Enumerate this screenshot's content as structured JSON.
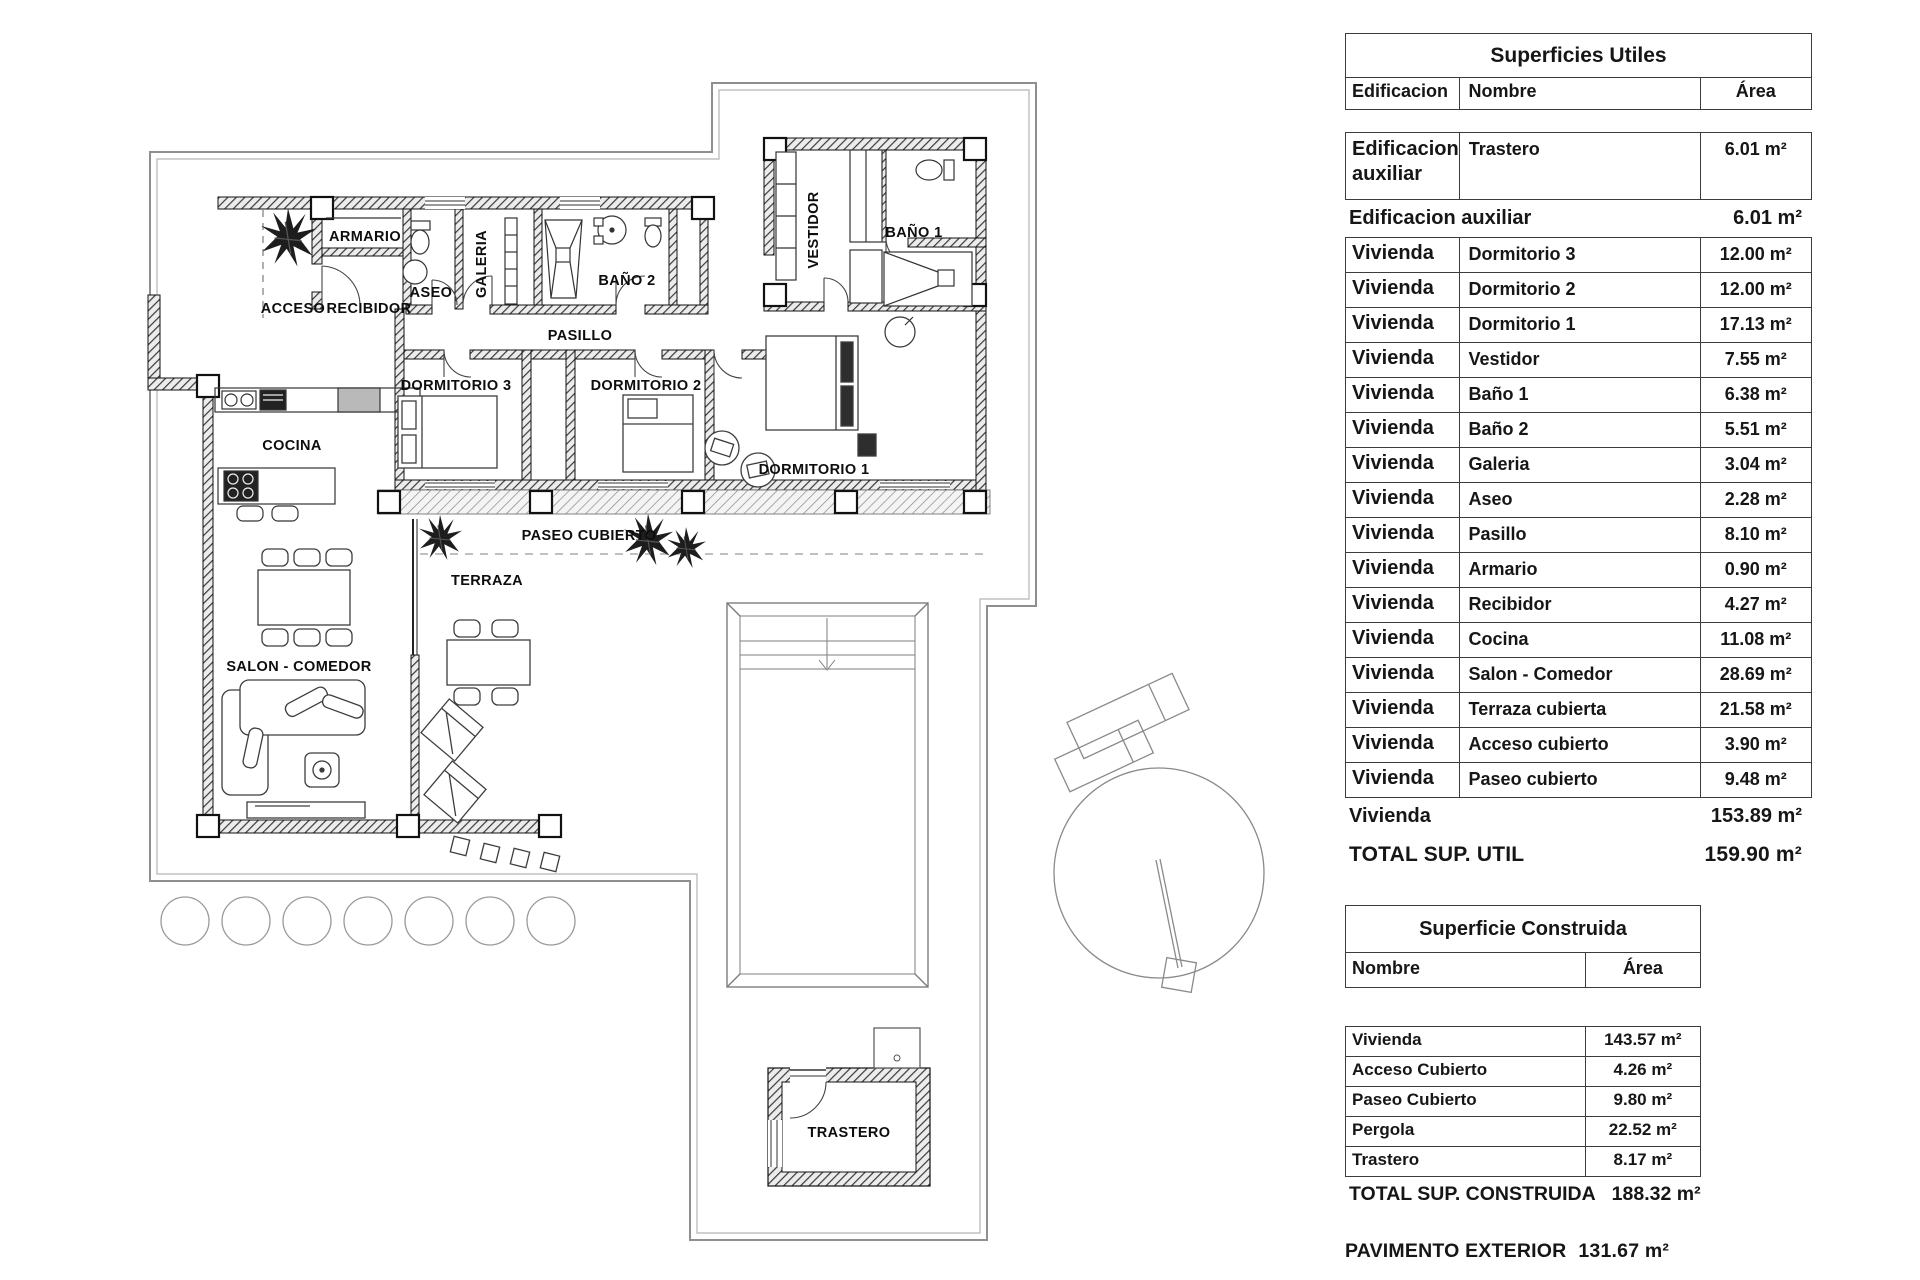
{
  "floor_plan": {
    "rooms": [
      {
        "label": "ARMARIO",
        "x": 365,
        "y": 241
      },
      {
        "label": "ACCESO",
        "x": 293,
        "y": 313
      },
      {
        "label": "RECIBIDOR",
        "x": 369,
        "y": 313
      },
      {
        "label": "ASEO",
        "x": 431,
        "y": 297
      },
      {
        "label": "GALERIA",
        "x": 486,
        "y": 264,
        "rot": -90
      },
      {
        "label": "BAÑO 2",
        "x": 627,
        "y": 285
      },
      {
        "label": "BAÑO 1",
        "x": 914,
        "y": 237
      },
      {
        "label": "VESTIDOR",
        "x": 818,
        "y": 230,
        "rot": -90
      },
      {
        "label": "PASILLO",
        "x": 580,
        "y": 340
      },
      {
        "label": "DORMITORIO 3",
        "x": 456,
        "y": 390
      },
      {
        "label": "DORMITORIO 2",
        "x": 646,
        "y": 390
      },
      {
        "label": "DORMITORIO 1",
        "x": 814,
        "y": 474
      },
      {
        "label": "COCINA",
        "x": 292,
        "y": 450
      },
      {
        "label": "PASEO CUBIERTO",
        "x": 589,
        "y": 540
      },
      {
        "label": "TERRAZA",
        "x": 487,
        "y": 585
      },
      {
        "label": "SALON - COMEDOR",
        "x": 299,
        "y": 671
      },
      {
        "label": "TRASTERO",
        "x": 849,
        "y": 1137
      }
    ]
  },
  "tables": {
    "superficies_utiles": {
      "title": "Superficies Utiles",
      "columns": {
        "edificacion": "Edificacion",
        "nombre": "Nombre",
        "area": "Área"
      },
      "aux_row": {
        "edificacion": "Edificacion auxiliar",
        "nombre": "Trastero",
        "area": "6.01 m²"
      },
      "aux_subtotal": {
        "label": "Edificacion auxiliar",
        "area": "6.01 m²"
      },
      "vivienda_rows": [
        {
          "edificacion": "Vivienda",
          "nombre": "Dormitorio 3",
          "area": "12.00 m²"
        },
        {
          "edificacion": "Vivienda",
          "nombre": "Dormitorio 2",
          "area": "12.00 m²"
        },
        {
          "edificacion": "Vivienda",
          "nombre": "Dormitorio 1",
          "area": "17.13 m²"
        },
        {
          "edificacion": "Vivienda",
          "nombre": "Vestidor",
          "area": "7.55 m²"
        },
        {
          "edificacion": "Vivienda",
          "nombre": "Baño 1",
          "area": "6.38 m²"
        },
        {
          "edificacion": "Vivienda",
          "nombre": "Baño 2",
          "area": "5.51 m²"
        },
        {
          "edificacion": "Vivienda",
          "nombre": "Galeria",
          "area": "3.04 m²"
        },
        {
          "edificacion": "Vivienda",
          "nombre": "Aseo",
          "area": "2.28 m²"
        },
        {
          "edificacion": "Vivienda",
          "nombre": "Pasillo",
          "area": "8.10 m²"
        },
        {
          "edificacion": "Vivienda",
          "nombre": "Armario",
          "area": "0.90 m²"
        },
        {
          "edificacion": "Vivienda",
          "nombre": "Recibidor",
          "area": "4.27 m²"
        },
        {
          "edificacion": "Vivienda",
          "nombre": "Cocina",
          "area": "11.08 m²"
        },
        {
          "edificacion": "Vivienda",
          "nombre": "Salon - Comedor",
          "area": "28.69 m²"
        },
        {
          "edificacion": "Vivienda",
          "nombre": "Terraza cubierta",
          "area": "21.58 m²"
        },
        {
          "edificacion": "Vivienda",
          "nombre": "Acceso cubierto",
          "area": "3.90 m²"
        },
        {
          "edificacion": "Vivienda",
          "nombre": "Paseo cubierto",
          "area": "9.48 m²"
        }
      ],
      "vivienda_subtotal": {
        "label": "Vivienda",
        "area": "153.89 m²"
      },
      "total": {
        "label": "TOTAL SUP. UTIL",
        "area": "159.90 m²"
      }
    },
    "superficie_construida": {
      "title": "Superficie Construida",
      "columns": {
        "nombre": "Nombre",
        "area": "Área"
      },
      "rows": [
        {
          "nombre": "Vivienda",
          "area": "143.57 m²"
        },
        {
          "nombre": "Acceso Cubierto",
          "area": "4.26 m²"
        },
        {
          "nombre": "Paseo Cubierto",
          "area": "9.80 m²"
        },
        {
          "nombre": "Pergola",
          "area": "22.52 m²"
        },
        {
          "nombre": "Trastero",
          "area": "8.17 m²"
        }
      ],
      "total": {
        "label": "TOTAL SUP. CONSTRUIDA",
        "area": "188.32 m²"
      }
    },
    "pavimento_exterior": {
      "label": "PAVIMENTO EXTERIOR",
      "area": "131.67 m²"
    }
  },
  "colors": {
    "wall": "#1a1a1a",
    "boundary": "#999999",
    "text": "#111111",
    "background": "#ffffff"
  }
}
